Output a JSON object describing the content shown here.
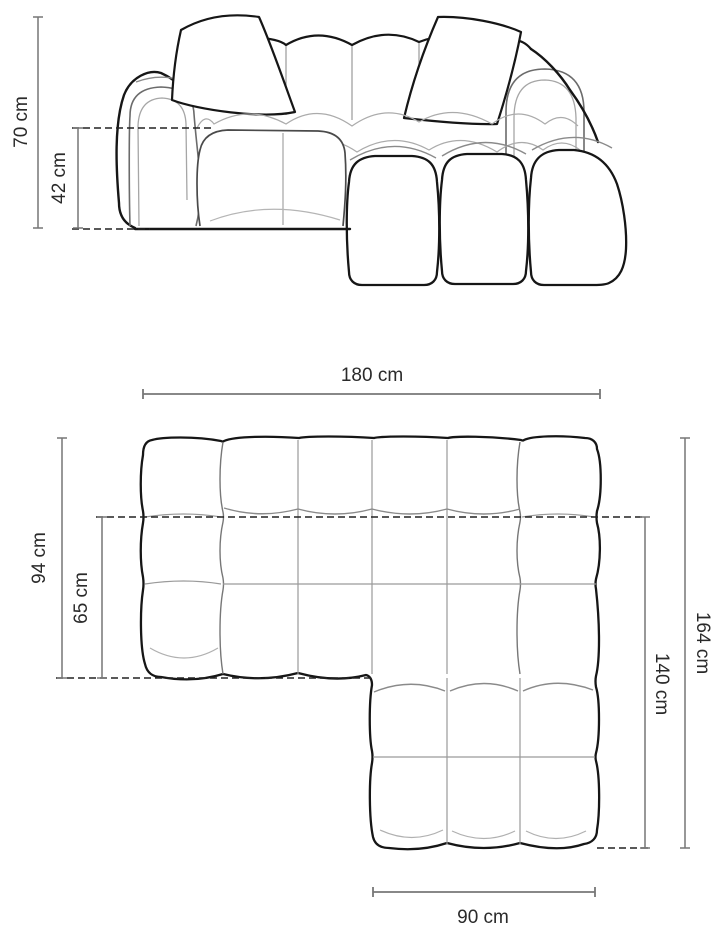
{
  "diagram": {
    "unit": "cm",
    "background_color": "#ffffff",
    "line_colors": {
      "outline": "#161616",
      "seam_light": "#ababab",
      "seam_medium": "#6b6b6b",
      "dimension_line": "#777777",
      "dashed_line": "#222222",
      "label_text": "#2a2a2a"
    },
    "front_view": {
      "dims": {
        "total_height": {
          "value": 70,
          "unit": "cm",
          "label": "70 cm"
        },
        "seat_height": {
          "value": 42,
          "unit": "cm",
          "label": "42 cm"
        }
      }
    },
    "plan_view": {
      "dims": {
        "total_width": {
          "value": 180,
          "unit": "cm",
          "label": "180 cm"
        },
        "body_depth": {
          "value": 94,
          "unit": "cm",
          "label": "94 cm"
        },
        "seat_depth": {
          "value": 65,
          "unit": "cm",
          "label": "65 cm"
        },
        "total_depth": {
          "value": 164,
          "unit": "cm",
          "label": "164 cm"
        },
        "chaise_depth": {
          "value": 140,
          "unit": "cm",
          "label": "140 cm"
        },
        "chaise_width": {
          "value": 90,
          "unit": "cm",
          "label": "90 cm"
        }
      }
    }
  }
}
